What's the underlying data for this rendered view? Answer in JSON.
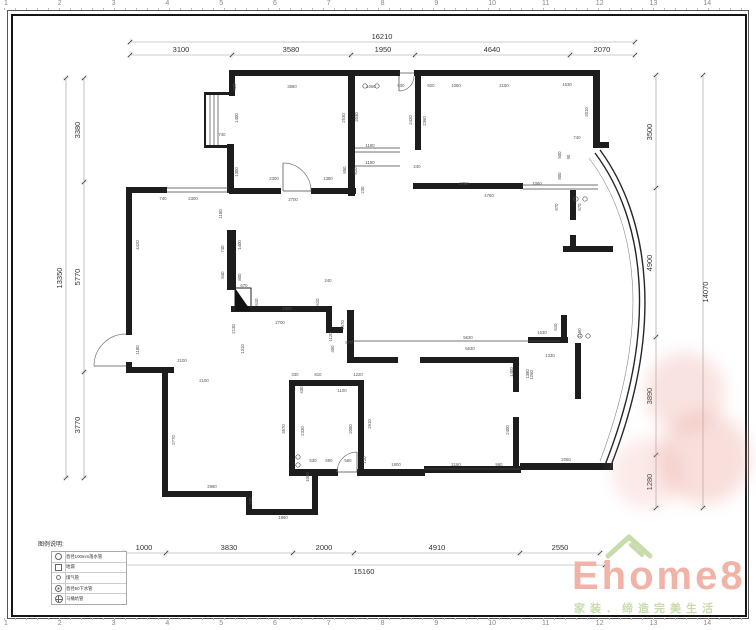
{
  "ruler": {
    "numbers": [
      "1",
      "2",
      "3",
      "4",
      "5",
      "6",
      "7",
      "8",
      "9",
      "10",
      "11",
      "12",
      "13",
      "14"
    ]
  },
  "dims": {
    "big_labels": [
      [
        "16210",
        382,
        39,
        "h"
      ],
      [
        "3100",
        181,
        52,
        "h"
      ],
      [
        "3580",
        291,
        52,
        "h"
      ],
      [
        "1950",
        383,
        52,
        "h"
      ],
      [
        "4640",
        492,
        52,
        "h"
      ],
      [
        "2070",
        602,
        52,
        "h"
      ],
      [
        "13350",
        62,
        278,
        "v"
      ],
      [
        "3380",
        80,
        130,
        "v"
      ],
      [
        "5770",
        80,
        277,
        "v"
      ],
      [
        "3770",
        80,
        425,
        "v"
      ],
      [
        "14070",
        708,
        292,
        "v"
      ],
      [
        "3500",
        652,
        132,
        "v"
      ],
      [
        "4900",
        652,
        263,
        "v"
      ],
      [
        "3890",
        652,
        396,
        "v"
      ],
      [
        "1280",
        652,
        482,
        "v"
      ],
      [
        "15160",
        364,
        574,
        "h"
      ],
      [
        "1000",
        144,
        550,
        "h"
      ],
      [
        "3830",
        229,
        550,
        "h"
      ],
      [
        "2000",
        324,
        550,
        "h"
      ],
      [
        "4910",
        437,
        550,
        "h"
      ],
      [
        "2550",
        560,
        550,
        "h"
      ]
    ],
    "lines": [
      {
        "o": "h",
        "c": 42,
        "t": [
          130,
          635
        ]
      },
      {
        "o": "h",
        "c": 55,
        "t": [
          130,
          232,
          351,
          415,
          570,
          635
        ]
      },
      {
        "o": "h",
        "c": 553,
        "t": [
          123,
          166,
          293,
          354,
          520,
          600
        ]
      },
      {
        "o": "h",
        "c": 565,
        "t": [
          123,
          605
        ]
      },
      {
        "o": "v",
        "c": 66,
        "t": [
          78,
          478
        ]
      },
      {
        "o": "v",
        "c": 84,
        "t": [
          78,
          182,
          372,
          478
        ]
      },
      {
        "o": "v",
        "c": 656,
        "t": [
          75,
          188,
          337,
          455,
          508
        ]
      },
      {
        "o": "v",
        "c": 703,
        "t": [
          75,
          508
        ]
      }
    ]
  },
  "plan": {
    "walls": [
      [
        229,
        70,
        126,
        6
      ],
      [
        352,
        70,
        48,
        6
      ],
      [
        414,
        70,
        186,
        6
      ],
      [
        229,
        70,
        6,
        26
      ],
      [
        205,
        92,
        27,
        3
      ],
      [
        205,
        145,
        27,
        3
      ],
      [
        204,
        92,
        2,
        56
      ],
      [
        227,
        144,
        7,
        49
      ],
      [
        126,
        187,
        41,
        6
      ],
      [
        126,
        187,
        6,
        148
      ],
      [
        126,
        362,
        6,
        11
      ],
      [
        126,
        367,
        48,
        6
      ],
      [
        162,
        367,
        6,
        130
      ],
      [
        162,
        491,
        90,
        6
      ],
      [
        246,
        491,
        6,
        24
      ],
      [
        246,
        509,
        72,
        6
      ],
      [
        312,
        473,
        6,
        40
      ],
      [
        289,
        469,
        49,
        7
      ],
      [
        357,
        469,
        68,
        7
      ],
      [
        424,
        466,
        97,
        7
      ],
      [
        520,
        463,
        93,
        7
      ],
      [
        289,
        380,
        6,
        96
      ],
      [
        289,
        380,
        75,
        6
      ],
      [
        358,
        380,
        6,
        96
      ],
      [
        347,
        310,
        7,
        53
      ],
      [
        352,
        357,
        46,
        6
      ],
      [
        420,
        357,
        94,
        6
      ],
      [
        513,
        357,
        6,
        35
      ],
      [
        513,
        417,
        6,
        53
      ],
      [
        528,
        337,
        40,
        6
      ],
      [
        561,
        315,
        6,
        28
      ],
      [
        575,
        343,
        6,
        56
      ],
      [
        570,
        190,
        6,
        30
      ],
      [
        570,
        235,
        6,
        17
      ],
      [
        563,
        246,
        50,
        6
      ],
      [
        413,
        183,
        110,
        6
      ],
      [
        593,
        70,
        7,
        78
      ],
      [
        593,
        142,
        16,
        6
      ],
      [
        229,
        188,
        52,
        6
      ],
      [
        311,
        188,
        45,
        6
      ],
      [
        227,
        230,
        9,
        60
      ],
      [
        231,
        306,
        101,
        6
      ],
      [
        326,
        306,
        6,
        27
      ],
      [
        326,
        327,
        17,
        6
      ],
      [
        348,
        70,
        7,
        126
      ],
      [
        415,
        70,
        6,
        80
      ]
    ],
    "thin": [
      [
        167,
        188,
        229,
        188
      ],
      [
        167,
        192,
        229,
        192
      ],
      [
        210,
        95,
        210,
        145
      ],
      [
        214,
        95,
        214,
        145
      ],
      [
        218,
        95,
        218,
        145
      ],
      [
        523,
        185,
        598,
        185
      ],
      [
        523,
        189,
        598,
        189
      ],
      [
        355,
        148,
        400,
        148
      ],
      [
        355,
        152,
        400,
        152
      ],
      [
        355,
        166,
        400,
        166
      ],
      [
        283,
        191,
        311,
        191
      ],
      [
        337,
        472,
        357,
        472
      ],
      [
        399,
        73,
        414,
        73
      ],
      [
        352,
        341,
        560,
        341
      ],
      [
        424,
        469,
        520,
        469
      ]
    ],
    "curves": [
      "M 600,150 C 650,218 665,330 610,468",
      "M 595,153 C 645,220 659,328 605,465",
      "M 589,158 C 638,223 652,324 600,461"
    ],
    "doors": [
      "M 126,334 A 32 32 0 0 0 94,366",
      "M 414,76 A 15 15 0 0 1 399,91",
      "M 337,472 A 20 20 0 0 1 357,452",
      "M 311,191 A 28 28 0 0 0 283,163"
    ],
    "door_leaves": [
      [
        94,
        366,
        126,
        366
      ],
      [
        399,
        76,
        399,
        91
      ],
      [
        357,
        452,
        357,
        472
      ],
      [
        283,
        163,
        283,
        191
      ]
    ],
    "circles": [
      [
        365,
        86
      ],
      [
        377,
        86
      ],
      [
        576,
        199
      ],
      [
        585,
        199
      ],
      [
        298,
        457
      ],
      [
        298,
        465
      ],
      [
        580,
        336
      ],
      [
        588,
        336
      ]
    ],
    "flue": {
      "box": [
        235,
        288,
        16,
        23
      ],
      "tri": [
        [
          235,
          288
        ],
        [
          235,
          311
        ],
        [
          251,
          311
        ]
      ]
    },
    "labels": [
      [
        "620",
        236,
        87,
        "v"
      ],
      [
        "3580",
        292,
        88,
        "h"
      ],
      [
        "1400",
        238,
        118,
        "v"
      ],
      [
        "740",
        222,
        136,
        "h"
      ],
      [
        "1300",
        238,
        172,
        "v"
      ],
      [
        "2300",
        274,
        180,
        "h"
      ],
      [
        "1380",
        328,
        180,
        "h"
      ],
      [
        "2700",
        293,
        201,
        "h"
      ],
      [
        "2530",
        345,
        118,
        "v"
      ],
      [
        "2030",
        358,
        117,
        "v"
      ],
      [
        "1190",
        370,
        147,
        "h"
      ],
      [
        "1190",
        370,
        164,
        "h"
      ],
      [
        "850",
        346,
        170,
        "v"
      ],
      [
        "820",
        357,
        171,
        "v"
      ],
      [
        "230",
        364,
        190,
        "v"
      ],
      [
        "740",
        163,
        200,
        "h"
      ],
      [
        "2300",
        193,
        200,
        "h"
      ],
      [
        "1060",
        371,
        88,
        "h"
      ],
      [
        "530",
        401,
        87,
        "h"
      ],
      [
        "240",
        417,
        168,
        "h"
      ],
      [
        "2420",
        412,
        120,
        "v"
      ],
      [
        "2360",
        426,
        121,
        "v"
      ],
      [
        "920",
        431,
        87,
        "h"
      ],
      [
        "1060",
        456,
        87,
        "h"
      ],
      [
        "2150",
        504,
        87,
        "h"
      ],
      [
        "1530",
        567,
        86,
        "h"
      ],
      [
        "2010",
        588,
        112,
        "v"
      ],
      [
        "740",
        577,
        139,
        "h"
      ],
      [
        "500",
        561,
        155,
        "v"
      ],
      [
        "90",
        570,
        157,
        "v"
      ],
      [
        "800",
        561,
        176,
        "v"
      ],
      [
        "2790",
        464,
        185,
        "h"
      ],
      [
        "1060",
        537,
        185,
        "h"
      ],
      [
        "4760",
        489,
        197,
        "h"
      ],
      [
        "670",
        558,
        207,
        "v"
      ],
      [
        "670",
        581,
        207,
        "v"
      ],
      [
        "1180",
        222,
        214,
        "v"
      ],
      [
        "4420",
        139,
        245,
        "v"
      ],
      [
        "740",
        224,
        249,
        "v"
      ],
      [
        "1400",
        241,
        245,
        "v"
      ],
      [
        "840",
        224,
        275,
        "v"
      ],
      [
        "800",
        241,
        277,
        "v"
      ],
      [
        "670",
        244,
        287,
        "h"
      ],
      [
        "610",
        258,
        302,
        "v"
      ],
      [
        "240",
        328,
        282,
        "h"
      ],
      [
        "2300",
        287,
        310,
        "h"
      ],
      [
        "2700",
        280,
        324,
        "h"
      ],
      [
        "610",
        319,
        302,
        "v"
      ],
      [
        "1570",
        344,
        325,
        "v"
      ],
      [
        "2130",
        235,
        329,
        "v"
      ],
      [
        "1310",
        244,
        349,
        "v"
      ],
      [
        "1120",
        332,
        337,
        "v"
      ],
      [
        "450",
        334,
        349,
        "v"
      ],
      [
        "870",
        349,
        344,
        "h"
      ],
      [
        "1180",
        139,
        350,
        "v"
      ],
      [
        "2100",
        182,
        362,
        "h"
      ],
      [
        "2100",
        204,
        382,
        "h"
      ],
      [
        "5630",
        468,
        339,
        "h"
      ],
      [
        "5630",
        470,
        350,
        "h"
      ],
      [
        "1630",
        542,
        334,
        "h"
      ],
      [
        "610",
        557,
        327,
        "v"
      ],
      [
        "1150",
        581,
        333,
        "v"
      ],
      [
        "1330",
        550,
        357,
        "h"
      ],
      [
        "1260",
        533,
        375,
        "v"
      ],
      [
        "1400",
        513,
        372,
        "v"
      ],
      [
        "2770",
        175,
        440,
        "v"
      ],
      [
        "2980",
        212,
        488,
        "h"
      ],
      [
        "240",
        252,
        501,
        "v"
      ],
      [
        "1860",
        283,
        519,
        "h"
      ],
      [
        "1080",
        309,
        477,
        "v"
      ],
      [
        "330",
        295,
        376,
        "h"
      ],
      [
        "810",
        318,
        376,
        "h"
      ],
      [
        "1220",
        358,
        376,
        "h"
      ],
      [
        "1100",
        342,
        392,
        "h"
      ],
      [
        "430",
        303,
        390,
        "v"
      ],
      [
        "2330",
        304,
        431,
        "v"
      ],
      [
        "3670",
        285,
        429,
        "v"
      ],
      [
        "2080",
        352,
        429,
        "v"
      ],
      [
        "2610",
        371,
        424,
        "v"
      ],
      [
        "530",
        313,
        462,
        "h"
      ],
      [
        "690",
        329,
        462,
        "h"
      ],
      [
        "560",
        348,
        462,
        "h"
      ],
      [
        "120",
        366,
        460,
        "v"
      ],
      [
        "1800",
        396,
        466,
        "h"
      ],
      [
        "2160",
        456,
        466,
        "h"
      ],
      [
        "960",
        499,
        466,
        "h"
      ],
      [
        "2400",
        509,
        430,
        "v"
      ],
      [
        "1380",
        529,
        374,
        "v"
      ],
      [
        "2050",
        566,
        461,
        "h"
      ]
    ]
  },
  "legend": {
    "title": "图例说明:",
    "rows": [
      {
        "sym": "sym-circle-lg",
        "label": "直径100mm落水管"
      },
      {
        "sym": "sym-square",
        "label": "地漏"
      },
      {
        "sym": "sym-circle-sm",
        "label": "煤气管"
      },
      {
        "sym": "sym-circle-dot",
        "label": "直径50下水管"
      },
      {
        "sym": "sym-circle-cross",
        "label": "马桶坑管"
      }
    ]
  },
  "watermark": {
    "brand": "Ehome8",
    "tagline": "家装．缔造完美生活"
  }
}
